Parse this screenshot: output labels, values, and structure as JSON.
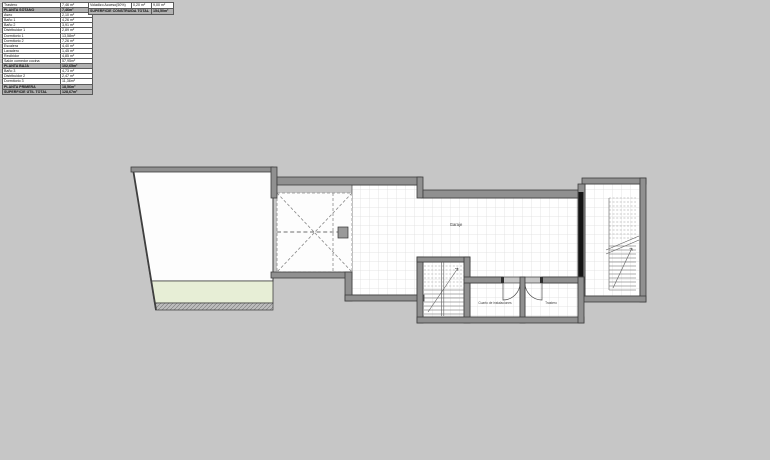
{
  "colors": {
    "background": "#c6c6c6",
    "wall": "#909090",
    "wall_outline": "#3d3d3d",
    "floor": "#ffffff",
    "grid_line": "#dcdcdc",
    "pool": "#e7eed6",
    "section_black": "#141414",
    "table_header_bg": "#b2b2b2"
  },
  "surface_table": {
    "rows": [
      {
        "label": "Trastero",
        "value": "7,46 m²"
      },
      {
        "label": "PLANTA SÓTANO",
        "value": "7,46m²"
      },
      {
        "label": "Aseo",
        "value": "2,10 m²"
      },
      {
        "label": "Baño 1",
        "value": "4,26 m²"
      },
      {
        "label": "Baño 2",
        "value": "3,91 m²"
      },
      {
        "label": "Distribuidor 1",
        "value": "2,89 m²"
      },
      {
        "label": "Dormitorio 1",
        "value": "13,58m²"
      },
      {
        "label": "Dormitorio 2",
        "value": "7,26 m²"
      },
      {
        "label": "Escalera",
        "value": "4,40 m²"
      },
      {
        "label": "Lavadero",
        "value": "1,45 m²"
      },
      {
        "label": "Recibidor",
        "value": "4,85 m²"
      },
      {
        "label": "Salón comedor cocina",
        "value": "57,95m²"
      },
      {
        "label": "PLANTA BAJA",
        "value": "102,65m²"
      },
      {
        "label": "Baño 3",
        "value": "4,73 m²"
      },
      {
        "label": "Distribuidor 2",
        "value": "2,47 m²"
      },
      {
        "label": "Dormitorio 3",
        "value": "11,36m²"
      },
      {
        "label": "PLANTA PRIMERA",
        "value": "18,56m²"
      },
      {
        "label": "SUPERFICIE ÚTIL TOTAL",
        "value": "128,67m²"
      }
    ]
  },
  "built_table": {
    "row1": {
      "label": "Voladizo Acceso(50%)",
      "mid": "0,20 m²",
      "value": "9,00 m²"
    },
    "row2": {
      "label": "SUPERFICIE CONSTRUIDA TOTAL",
      "value": "154,50m²"
    }
  },
  "plan": {
    "labels": {
      "garage": "Garaje",
      "utility_room": "Cuarto de instalaciones",
      "storage_room": "Trastero"
    }
  }
}
